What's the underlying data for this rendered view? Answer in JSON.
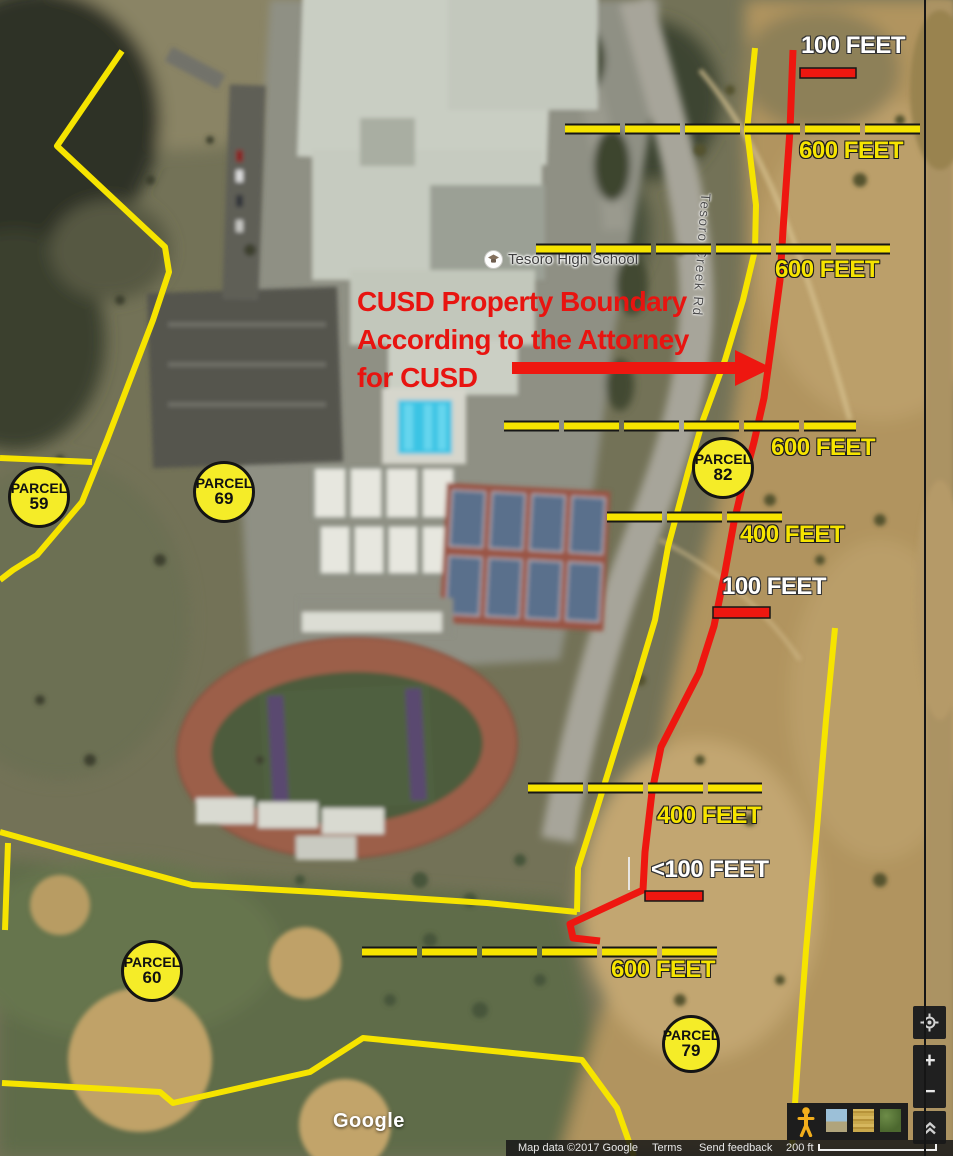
{
  "labels": {
    "school": "Tesoro High School",
    "road": "Tesoro Creek Rd",
    "google": "Google"
  },
  "annotation": {
    "note_line1": "CUSD Property Boundary",
    "note_line2": "According to the Attorney",
    "note_line3": "for CUSD"
  },
  "distance_labels": [
    {
      "text": "100 FEET",
      "tone": "white"
    },
    {
      "text": "600 FEET",
      "tone": "yellow"
    },
    {
      "text": "600 FEET",
      "tone": "yellow"
    },
    {
      "text": "600 FEET",
      "tone": "yellow"
    },
    {
      "text": "400 FEET",
      "tone": "yellow"
    },
    {
      "text": "100 FEET",
      "tone": "white"
    },
    {
      "text": "400 FEET",
      "tone": "yellow"
    },
    {
      "text": "<100 FEET",
      "tone": "white"
    },
    {
      "text": "600 FEET",
      "tone": "yellow"
    }
  ],
  "parcels": [
    {
      "label": "PARCEL",
      "number": "59"
    },
    {
      "label": "PARCEL",
      "number": "69"
    },
    {
      "label": "PARCEL",
      "number": "82"
    },
    {
      "label": "PARCEL",
      "number": "60"
    },
    {
      "label": "PARCEL",
      "number": "79"
    }
  ],
  "controls": {
    "zoom_in": "+",
    "zoom_out": "−"
  },
  "footer": {
    "map_data": "Map data ©2017 Google",
    "terms": "Terms",
    "feedback": "Send feedback",
    "scale": "200 ft"
  },
  "colors": {
    "annotation_yellow": "#f6e400",
    "annotation_red": "#ee1710",
    "parcel_fill": "#f5ec28"
  }
}
